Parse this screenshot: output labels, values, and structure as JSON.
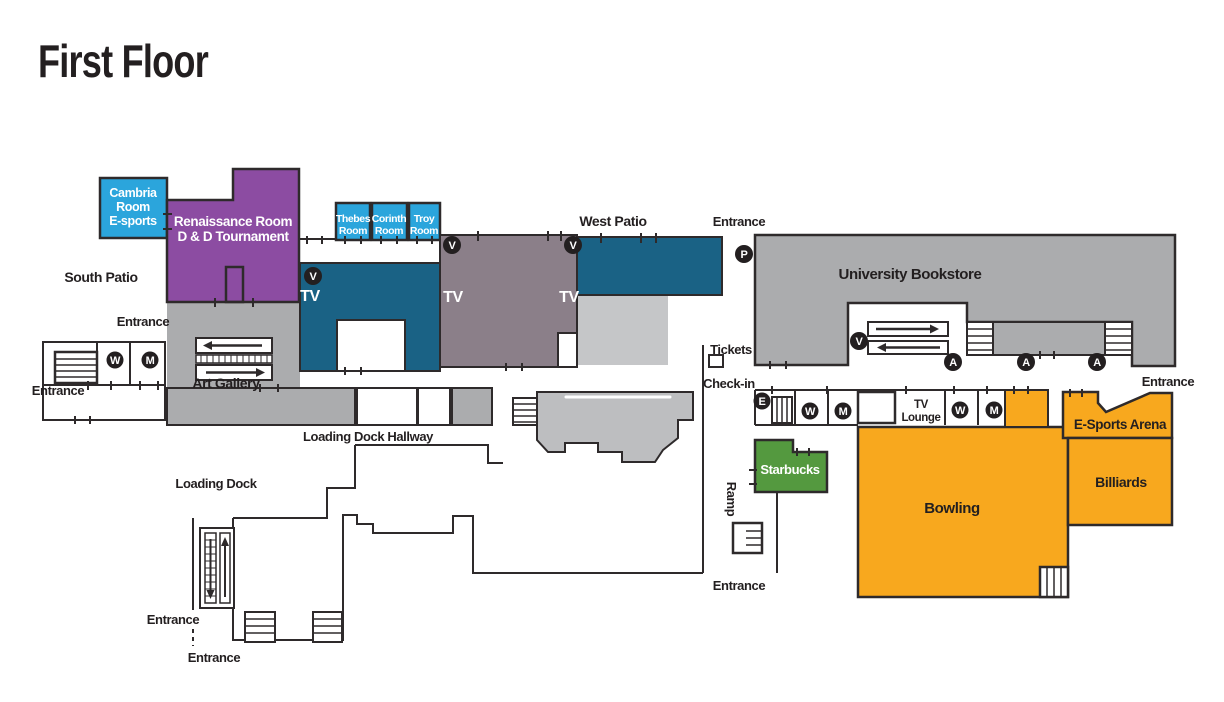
{
  "title": "First Floor",
  "palette": {
    "maroon": "#7B1E3F",
    "blue": "#2BA5DC",
    "purple": "#8C4CA2",
    "teal": "#1A6285",
    "taupe": "#8B7F89",
    "gray": "#ABACAE",
    "gray_light": "#C5C6C8",
    "gray_mid": "#BDBEC0",
    "orange": "#F8A81E",
    "green": "#54993F",
    "ink": "#231F20"
  },
  "rooms": {
    "cambria": [
      "Cambria",
      "Room",
      "E-sports"
    ],
    "renaissance": [
      "Renaissance Room",
      "D & D Tournament"
    ],
    "thebes": [
      "Thebes",
      "Room"
    ],
    "corinth": [
      "Corinth",
      "Room"
    ],
    "troy": [
      "Troy",
      "Room"
    ],
    "art_gallery": "Art Gallery",
    "university_bookstore": "University Bookstore",
    "tv_lounge": [
      "TV",
      "Lounge"
    ],
    "starbucks": "Starbucks",
    "bowling": "Bowling",
    "billiards": "Billiards",
    "esports_arena": "E-Sports Arena"
  },
  "labels": {
    "south_patio": "South Patio",
    "west_patio": "West Patio",
    "entrance": "Entrance",
    "tickets": "Tickets",
    "check_in": "Check-in",
    "ramp": "Ramp",
    "loading_dock": "Loading Dock",
    "loading_dock_hallway": "Loading Dock Hallway",
    "tv": "TV"
  },
  "icons": {
    "v": "V",
    "p": "P",
    "a": "A",
    "e": "E",
    "w": "W",
    "m": "M"
  }
}
